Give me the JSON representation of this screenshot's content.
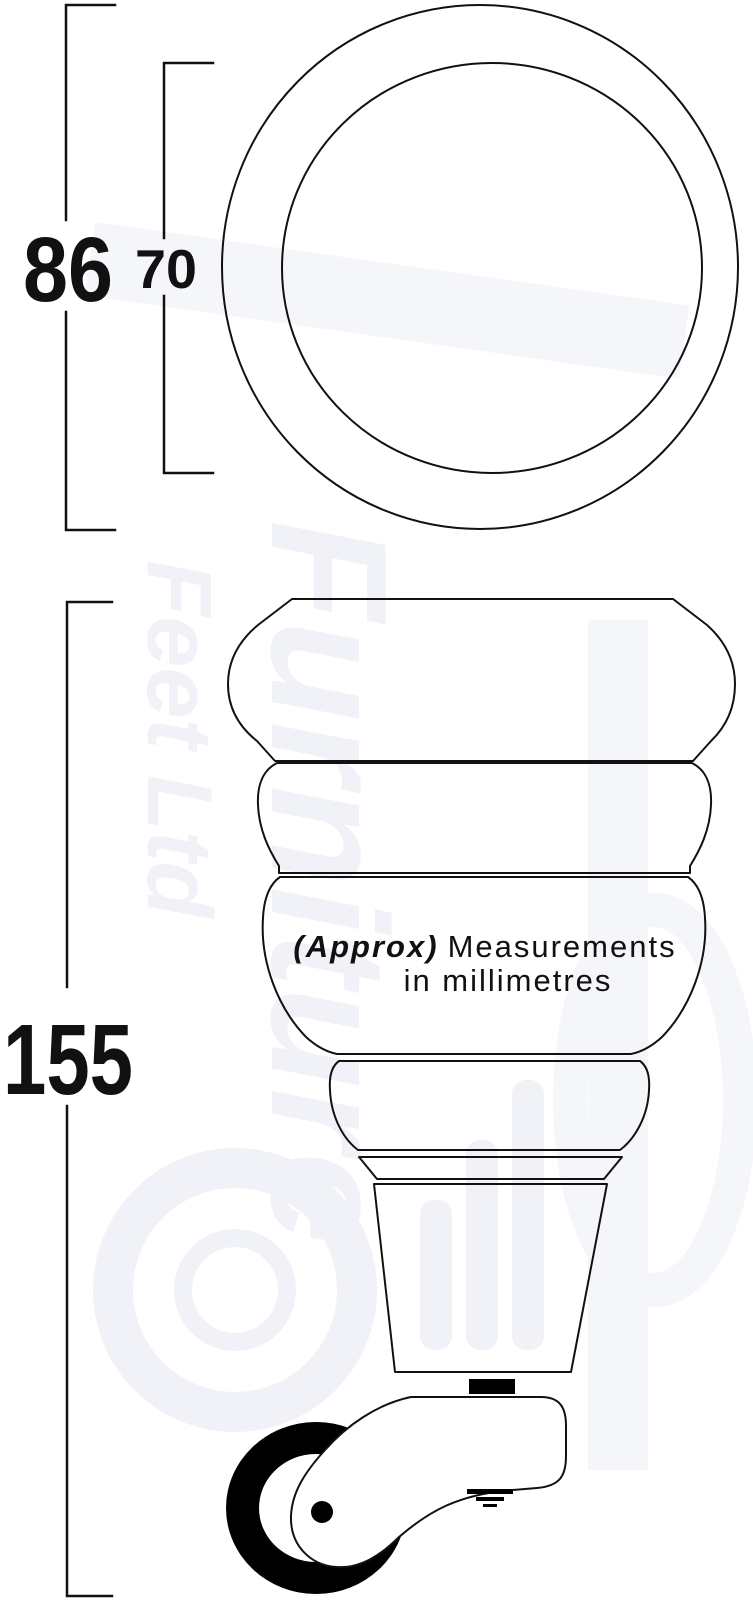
{
  "colors": {
    "line": "#111111",
    "bg": "#ffffff",
    "wm": "#f0f2f7",
    "wm2": "#f5f6fa",
    "wheel": "#000000"
  },
  "dimensions": {
    "outer_diameter": "86",
    "top_inner_diameter": "70",
    "overall_height": "155"
  },
  "note": {
    "approx": "(Approx)",
    "rest": "Measurements",
    "line2": "in millimetres"
  },
  "watermark": {
    "word1": "Furniture",
    "word2": "Feet Ltd"
  }
}
